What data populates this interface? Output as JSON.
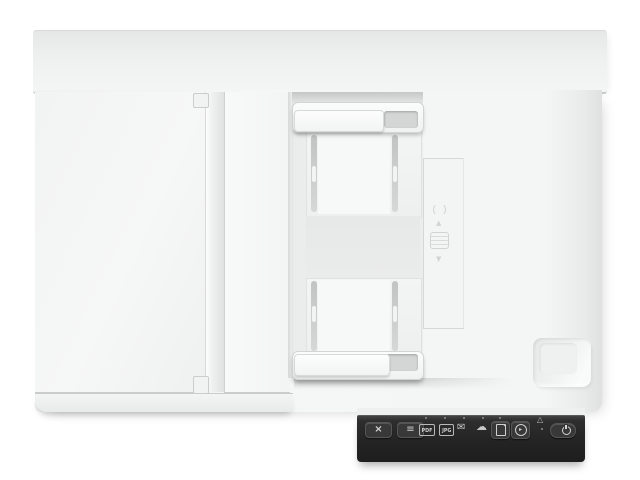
{
  "scene": {
    "description": "Top-down product photo of a white flatbed document scanner with an automatic document feeder and a dark control panel strip at the lower right",
    "background_color": "#ffffff",
    "body_color": "#f3f4f4",
    "control_panel_color": "#262626",
    "icon_color": "#cfcfcf"
  },
  "adf": {
    "up_glyph": "▲",
    "down_glyph": "▼"
  },
  "control_panel": {
    "cancel_glyph": "×",
    "menu_glyph": "≡",
    "pdf_label": "PDF",
    "jpg_label": "JPG",
    "email_glyph": "✉",
    "cloud_glyph": "☁",
    "scan_glyph": "▸",
    "warning_glyph": "△"
  }
}
